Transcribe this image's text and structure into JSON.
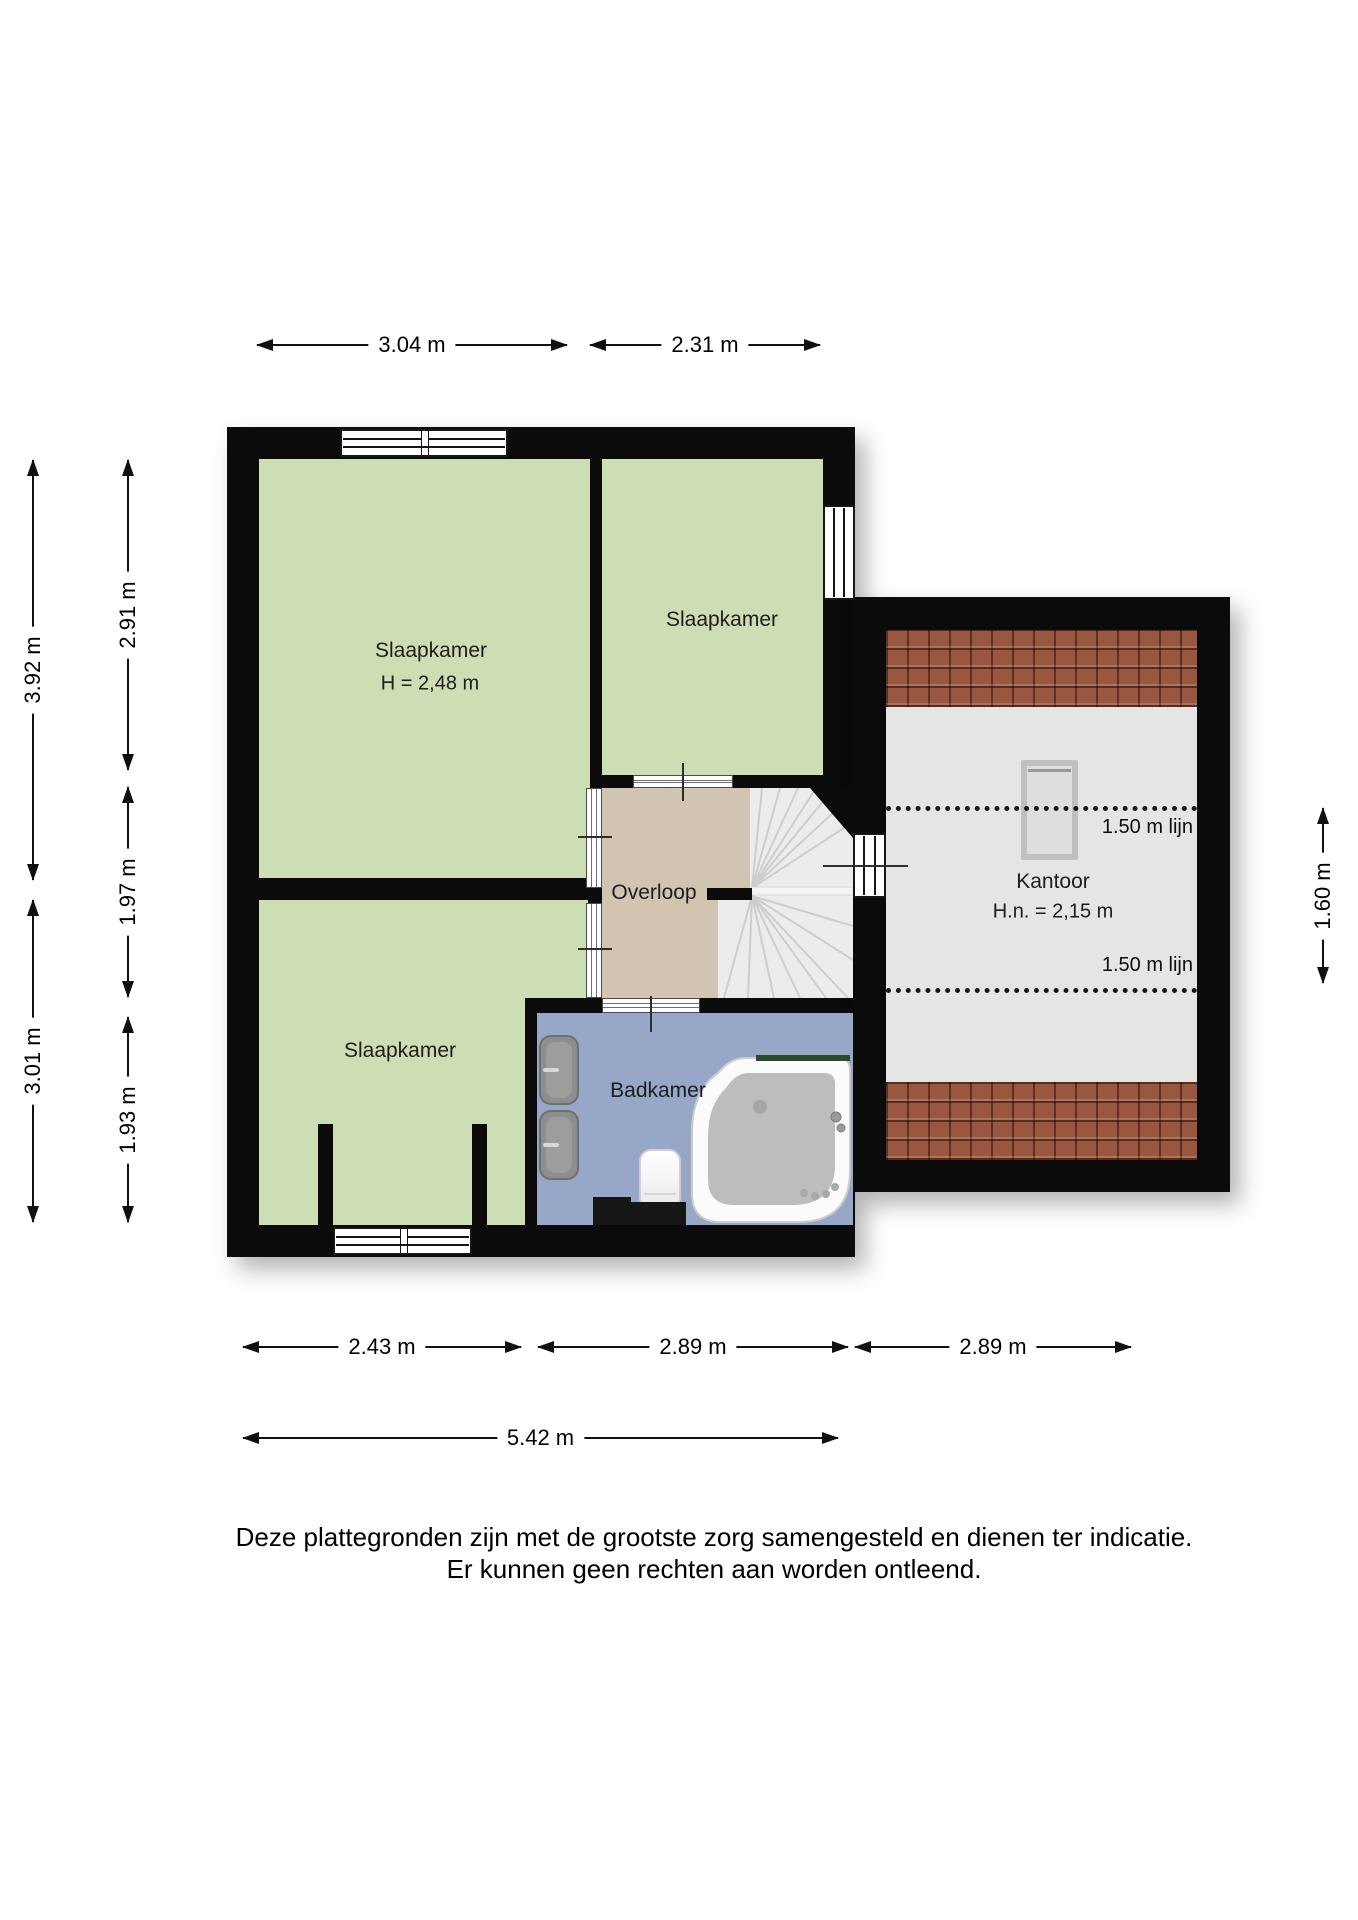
{
  "plan": {
    "rooms": {
      "bedroom_main": {
        "label": "Slaapkamer",
        "height_note": "H = 2,48 m"
      },
      "bedroom_top": {
        "label": "Slaapkamer"
      },
      "bedroom_bottom": {
        "label": "Slaapkamer"
      },
      "landing": {
        "label": "Overloop"
      },
      "bathroom": {
        "label": "Badkamer"
      },
      "office": {
        "label": "Kantoor",
        "height_note": "H.n. = 2,15 m",
        "roofline_top": "1.50 m lijn",
        "roofline_bottom": "1.50 m lijn"
      }
    },
    "dimensions": {
      "top": [
        {
          "label": "3.04 m"
        },
        {
          "label": "2.31 m"
        }
      ],
      "left_outer": [
        {
          "label": "3.92 m"
        },
        {
          "label": "3.01 m"
        }
      ],
      "left_inner": [
        {
          "label": "2.91 m"
        },
        {
          "label": "1.97 m"
        },
        {
          "label": "1.93 m"
        }
      ],
      "right": [
        {
          "label": "1.60 m"
        }
      ],
      "bottom": [
        {
          "label": "2.43 m"
        },
        {
          "label": "2.89 m"
        },
        {
          "label": "2.89 m"
        }
      ],
      "bottom_total": [
        {
          "label": "5.42 m"
        }
      ]
    },
    "colors": {
      "wall": "#0b0b0b",
      "bedroom_floor": "#cdddb4",
      "landing_floor": "#d1c4b0",
      "bathroom_floor": "#97a7c8",
      "office_floor": "#e5e5e5",
      "roof_tiles": "#9a5740",
      "stairs": "#ececec"
    },
    "footer": {
      "line1": "Deze plattegronden zijn met de grootste zorg samengesteld en dienen ter indicatie.",
      "line2": "Er kunnen geen rechten aan worden ontleend."
    }
  }
}
